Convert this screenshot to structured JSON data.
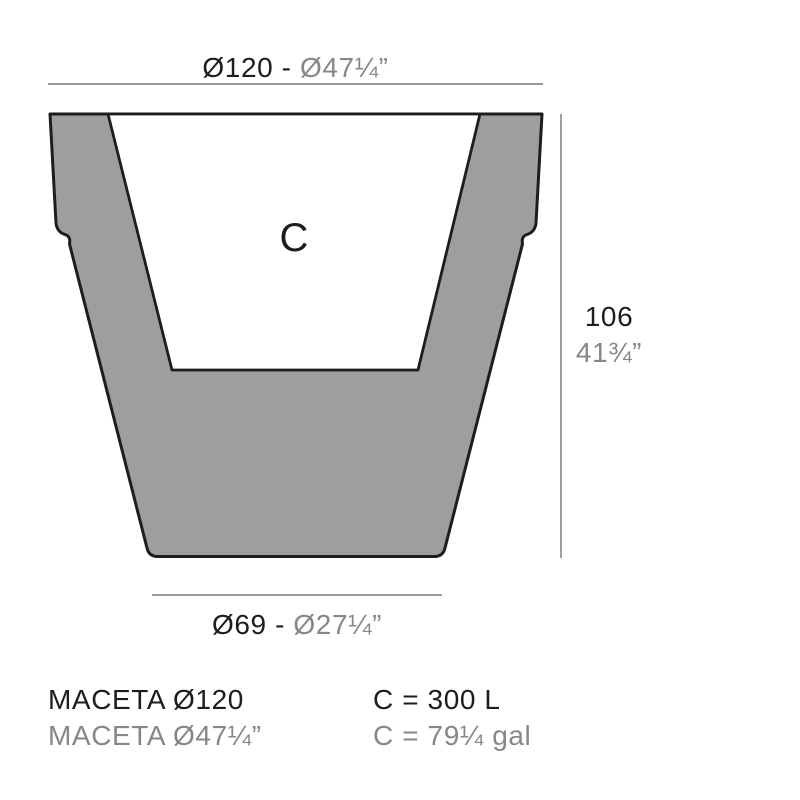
{
  "colors": {
    "ink": "#1d1d1b",
    "muted": "#878787",
    "fill": "#9e9e9d",
    "line": "#8c8c8c"
  },
  "diagram": {
    "top_dimension": {
      "metric": "Ø120",
      "separator": " - ",
      "imperial": "Ø47¼”"
    },
    "height_dimension": {
      "metric": "106",
      "imperial": "41¾”"
    },
    "bottom_dimension": {
      "metric": "Ø69",
      "separator": " - ",
      "imperial": "Ø27¼”"
    },
    "capacity_letter": "C"
  },
  "footer": {
    "model_metric": "MACETA Ø120",
    "model_imperial": "MACETA Ø47¼”",
    "capacity_metric": "C = 300 L",
    "capacity_imperial": "C = 79¼ gal"
  }
}
